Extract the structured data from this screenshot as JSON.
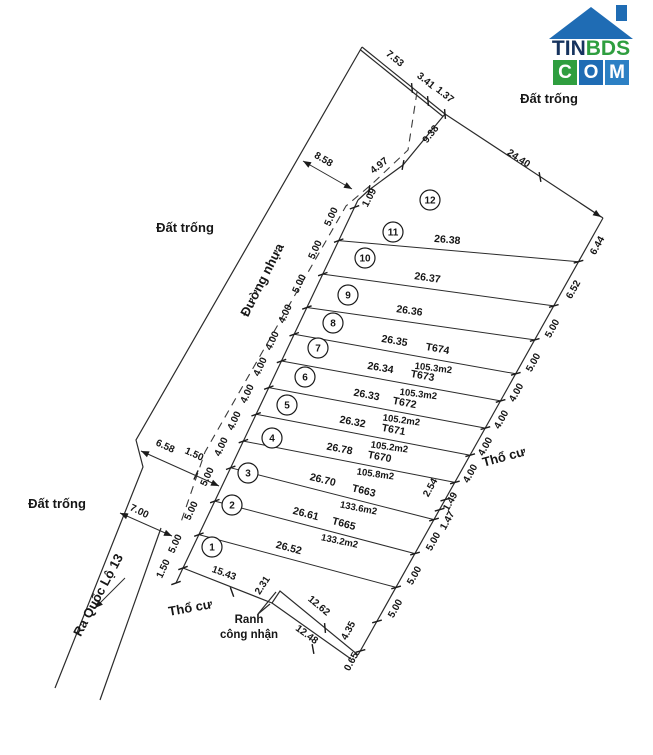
{
  "logo": {
    "word_part1": "TIN",
    "word_part2": "BDS",
    "tiles": [
      "C",
      "O",
      "M"
    ],
    "colors": {
      "roof": "#1f6cb4",
      "dark_text": "#16335e",
      "green": "#2f9e3f",
      "blue": "#1f6cb4",
      "blue2": "#2c80c4"
    }
  },
  "diagram": {
    "ink": "#2b2b2b",
    "solid": [
      {
        "name": "north-boundary-double-line",
        "pts": [
          [
            362,
            47
          ],
          [
            445,
            114
          ]
        ],
        "double": 1
      },
      {
        "name": "plot12-road-corner-edge",
        "pts": [
          [
            445,
            114
          ],
          [
            403,
            165
          ],
          [
            369,
            190
          ],
          [
            358,
            200
          ]
        ]
      },
      {
        "name": "northeast-boundary",
        "pts": [
          [
            445,
            114
          ],
          [
            603,
            218
          ]
        ]
      },
      {
        "name": "road-frontage-line",
        "pts": [
          [
            358,
            200
          ],
          [
            183,
            568
          ],
          [
            176,
            583
          ]
        ]
      },
      {
        "name": "rear-boundary-line",
        "pts": [
          [
            603,
            218
          ],
          [
            358,
            655
          ]
        ]
      },
      {
        "name": "south-boundary-upper",
        "pts": [
          [
            358,
            655
          ],
          [
            280,
            591
          ],
          [
            272,
            603
          ],
          [
            183,
            568
          ]
        ]
      },
      {
        "name": "recognized-boundary-line",
        "pts": [
          [
            351,
            659
          ],
          [
            272,
            603
          ]
        ]
      },
      {
        "name": "road-west-boundary",
        "pts": [
          [
            362,
            47
          ],
          [
            136,
            440
          ],
          [
            143,
            467
          ],
          [
            55,
            688
          ]
        ]
      },
      {
        "name": "road-east-lower-boundary",
        "pts": [
          [
            161,
            528
          ],
          [
            100,
            700
          ]
        ]
      },
      {
        "name": "ranh-leader-1",
        "pts": [
          [
            258,
            614
          ],
          [
            276,
            592
          ]
        ]
      },
      {
        "name": "ranh-leader-2",
        "pts": [
          [
            258,
            614
          ],
          [
            270,
            604
          ]
        ]
      }
    ],
    "dash": [
      {
        "name": "road-edge-dashed",
        "pts": [
          [
            417,
            92
          ],
          [
            408,
            150
          ],
          [
            372,
            184
          ],
          [
            346,
            206
          ],
          [
            205,
            452
          ],
          [
            180,
            525
          ]
        ]
      }
    ],
    "divisions": [
      {
        "p": [
          338.7,
          240.6,
          578.5,
          261.7
        ],
        "len": "26.38",
        "lx": 447,
        "ly": 243,
        "lr": 5
      },
      {
        "p": [
          322.8,
          274.1,
          553.8,
          305.9
        ],
        "len": "26.37",
        "lx": 427,
        "ly": 281,
        "lr": 8
      },
      {
        "p": [
          306.9,
          307.5,
          534.7,
          339.9
        ],
        "len": "26.36",
        "lx": 409,
        "ly": 314,
        "lr": 8
      },
      {
        "p": [
          294.2,
          334.2,
          515.8,
          373.8
        ],
        "len": "26.35",
        "lx": 394,
        "ly": 344,
        "lr": 10,
        "code": "T674",
        "cx": 437,
        "cy": 352,
        "area": "105.3m2",
        "ax": 433,
        "ay": 371
      },
      {
        "p": [
          281.5,
          361.0,
          500.6,
          400.9
        ],
        "len": "26.34",
        "lx": 380,
        "ly": 371,
        "lr": 10,
        "code": "T673",
        "cx": 422,
        "cy": 379,
        "area": "105.3m2",
        "ax": 418,
        "ay": 397
      },
      {
        "p": [
          268.8,
          387.6,
          485.4,
          428.1
        ],
        "len": "26.33",
        "lx": 366,
        "ly": 398,
        "lr": 11,
        "code": "T672",
        "cx": 404,
        "cy": 406,
        "area": "105.2m2",
        "ax": 401,
        "ay": 423
      },
      {
        "p": [
          256.1,
          414.3,
          470.2,
          455.2
        ],
        "len": "26.32",
        "lx": 352,
        "ly": 425,
        "lr": 11,
        "code": "T671",
        "cx": 393,
        "cy": 433,
        "area": "105.2m2",
        "ax": 389,
        "ay": 450
      },
      {
        "p": [
          243.4,
          441.1,
          454.9,
          482.4
        ],
        "len": "26.78",
        "lx": 339,
        "ly": 452,
        "lr": 11,
        "code": "T670",
        "cx": 379,
        "cy": 460,
        "area": "105.8m2",
        "ax": 375,
        "ay": 477
      },
      {
        "p": [
          230.7,
          467.8,
          434.0,
          519.6
        ],
        "len": "26.70",
        "lx": 322,
        "ly": 483,
        "lr": 14,
        "code": "T663",
        "cx": 363,
        "cy": 494,
        "area": "133.6m2",
        "ax": 358,
        "ay": 511
      },
      {
        "p": [
          214.8,
          501.1,
          415.0,
          553.6
        ],
        "len": "26.61",
        "lx": 305,
        "ly": 517,
        "lr": 15,
        "code": "T665",
        "cx": 343,
        "cy": 527,
        "area": "133.2m2",
        "ax": 339,
        "ay": 544
      },
      {
        "p": [
          198.9,
          534.6,
          396.1,
          587.4
        ],
        "len": "26.52",
        "lx": 288,
        "ly": 551,
        "lr": 15
      }
    ],
    "plots": [
      {
        "n": "12",
        "x": 430,
        "y": 200
      },
      {
        "n": "11",
        "x": 393,
        "y": 232
      },
      {
        "n": "10",
        "x": 365,
        "y": 258
      },
      {
        "n": "9",
        "x": 348,
        "y": 295
      },
      {
        "n": "8",
        "x": 333,
        "y": 323
      },
      {
        "n": "7",
        "x": 318,
        "y": 348
      },
      {
        "n": "6",
        "x": 305,
        "y": 377
      },
      {
        "n": "5",
        "x": 287,
        "y": 405
      },
      {
        "n": "4",
        "x": 272,
        "y": 438
      },
      {
        "n": "3",
        "x": 248,
        "y": 473
      },
      {
        "n": "2",
        "x": 232,
        "y": 505
      },
      {
        "n": "1",
        "x": 212,
        "y": 547
      }
    ],
    "dims": [
      {
        "t": "7.53",
        "x": 393,
        "y": 61,
        "r": 39
      },
      {
        "t": "3.41",
        "x": 424,
        "y": 83,
        "r": 39
      },
      {
        "t": "1.37",
        "x": 443,
        "y": 97,
        "r": 39
      },
      {
        "t": "24.40",
        "x": 517,
        "y": 161,
        "r": 33
      },
      {
        "t": "9.38",
        "x": 433,
        "y": 136,
        "r": -52
      },
      {
        "t": "4.97",
        "x": 381,
        "y": 168,
        "r": -38
      },
      {
        "t": "1.09",
        "x": 372,
        "y": 199,
        "r": -62
      },
      {
        "t": "8.58",
        "x": 322,
        "y": 162,
        "r": 30
      },
      {
        "t": "6.58",
        "x": 164,
        "y": 449,
        "r": 24
      },
      {
        "t": "1.50",
        "x": 193,
        "y": 457,
        "r": 24
      },
      {
        "t": "7.00",
        "x": 138,
        "y": 514,
        "r": 26
      },
      {
        "t": "1.50",
        "x": 166,
        "y": 570,
        "r": -65
      },
      {
        "t": "15.43",
        "x": 223,
        "y": 576,
        "r": 20
      },
      {
        "t": "2.31",
        "x": 265,
        "y": 587,
        "r": -57
      },
      {
        "t": "12.62",
        "x": 317,
        "y": 608,
        "r": 40
      },
      {
        "t": "12.48",
        "x": 305,
        "y": 637,
        "r": 36
      },
      {
        "t": "4.35",
        "x": 351,
        "y": 632,
        "r": -62
      },
      {
        "t": "0.65",
        "x": 354,
        "y": 663,
        "r": -62
      },
      {
        "t": "5.00",
        "x": 334,
        "y": 218,
        "r": -65
      },
      {
        "t": "5.00",
        "x": 318,
        "y": 251,
        "r": -65
      },
      {
        "t": "5.00",
        "x": 302,
        "y": 285,
        "r": -65
      },
      {
        "t": "4.00",
        "x": 288,
        "y": 315,
        "r": -65
      },
      {
        "t": "4.00",
        "x": 275,
        "y": 342,
        "r": -65
      },
      {
        "t": "4.00",
        "x": 263,
        "y": 368,
        "r": -65
      },
      {
        "t": "4.00",
        "x": 250,
        "y": 395,
        "r": -65
      },
      {
        "t": "4.00",
        "x": 237,
        "y": 422,
        "r": -65
      },
      {
        "t": "4.00",
        "x": 224,
        "y": 448,
        "r": -65
      },
      {
        "t": "5.00",
        "x": 210,
        "y": 478,
        "r": -65
      },
      {
        "t": "5.00",
        "x": 194,
        "y": 512,
        "r": -65
      },
      {
        "t": "5.00",
        "x": 178,
        "y": 545,
        "r": -65
      },
      {
        "t": "6.44",
        "x": 600,
        "y": 247,
        "r": -61
      },
      {
        "t": "6.52",
        "x": 576,
        "y": 291,
        "r": -61
      },
      {
        "t": "5.00",
        "x": 555,
        "y": 330,
        "r": -61
      },
      {
        "t": "5.00",
        "x": 536,
        "y": 364,
        "r": -61
      },
      {
        "t": "4.00",
        "x": 519,
        "y": 394,
        "r": -61
      },
      {
        "t": "4.00",
        "x": 504,
        "y": 421,
        "r": -61
      },
      {
        "t": "4.00",
        "x": 488,
        "y": 448,
        "r": -61
      },
      {
        "t": "4.00",
        "x": 473,
        "y": 475,
        "r": -61
      },
      {
        "t": "2.54",
        "x": 433,
        "y": 489,
        "r": -61
      },
      {
        "t": "1.49",
        "x": 453,
        "y": 503,
        "r": -61
      },
      {
        "t": "1.47",
        "x": 450,
        "y": 522,
        "r": -61
      },
      {
        "t": "5.00",
        "x": 436,
        "y": 543,
        "r": -61
      },
      {
        "t": "5.00",
        "x": 417,
        "y": 577,
        "r": -61
      },
      {
        "t": "5.00",
        "x": 398,
        "y": 610,
        "r": -61
      }
    ],
    "labels": [
      {
        "t": "Đất trống",
        "x": 185,
        "y": 232,
        "r": 0,
        "cls": "vn",
        "name": "label-dat-trong-west"
      },
      {
        "t": "Đất trống",
        "x": 549,
        "y": 103,
        "r": 0,
        "cls": "vn",
        "name": "label-dat-trong-northeast"
      },
      {
        "t": "Đất trống",
        "x": 57,
        "y": 508,
        "r": 0,
        "cls": "vn",
        "name": "label-dat-trong-southwest"
      },
      {
        "t": "Đường nhựa",
        "x": 266,
        "y": 282,
        "r": -63,
        "cls": "vn",
        "name": "label-duong-nhua"
      },
      {
        "t": "Thổ cư",
        "x": 505,
        "y": 461,
        "r": -15,
        "cls": "vn",
        "name": "label-tho-cu-east"
      },
      {
        "t": "Thổ cư",
        "x": 191,
        "y": 612,
        "r": -10,
        "cls": "vn",
        "name": "label-tho-cu-south"
      },
      {
        "t": "Ra Quốc Lộ 13",
        "x": 102,
        "y": 597,
        "r": -62,
        "cls": "vn",
        "name": "label-ra-quoc-lo-13"
      },
      {
        "t": "Ranh",
        "x": 249,
        "y": 623,
        "r": 0,
        "cls": "vnsm",
        "name": "label-ranh-cong-nhan-line1"
      },
      {
        "t": "công nhận",
        "x": 249,
        "y": 638,
        "r": 0,
        "cls": "vnsm",
        "name": "label-ranh-cong-nhan-line2"
      }
    ],
    "arrows": [
      {
        "p": [
          303,
          161,
          352,
          189
        ],
        "heads": 2,
        "name": "dim-arrow-8-58"
      },
      {
        "p": [
          141,
          451,
          219,
          486
        ],
        "heads": 2,
        "name": "dim-arrow-6-58-1-50"
      },
      {
        "p": [
          120,
          513,
          172,
          536
        ],
        "heads": 2,
        "name": "dim-arrow-7-00"
      },
      {
        "p": [
          125,
          578,
          95,
          608
        ],
        "heads": 1,
        "name": "direction-arrow-quoc-lo-13"
      },
      {
        "p": [
          580,
          203,
          601,
          217
        ],
        "heads": 1,
        "name": "dim-arrow-24-40-end"
      }
    ],
    "ticks": [
      [
        354.5,
        207.3,
        160
      ],
      [
        338.7,
        240.6,
        160
      ],
      [
        322.8,
        274.1,
        160
      ],
      [
        306.9,
        307.5,
        160
      ],
      [
        294.2,
        334.2,
        160
      ],
      [
        281.5,
        361,
        160
      ],
      [
        268.8,
        387.6,
        160
      ],
      [
        256.1,
        414.3,
        160
      ],
      [
        243.4,
        441.1,
        160
      ],
      [
        230.7,
        467.8,
        160
      ],
      [
        214.8,
        501.1,
        160
      ],
      [
        198.9,
        534.6,
        160
      ],
      [
        183,
        568,
        160
      ],
      [
        176,
        583,
        160
      ],
      [
        578.5,
        261.7,
        164
      ],
      [
        553.8,
        305.9,
        164
      ],
      [
        534.7,
        339.9,
        164
      ],
      [
        515.8,
        373.8,
        164
      ],
      [
        500.6,
        400.9,
        164
      ],
      [
        485.4,
        428.1,
        164
      ],
      [
        470.2,
        455.2,
        164
      ],
      [
        454.9,
        482.4,
        164
      ],
      [
        445.3,
        499.6,
        164
      ],
      [
        439.6,
        509.7,
        164
      ],
      [
        434,
        519.6,
        164
      ],
      [
        415,
        553.6,
        164
      ],
      [
        396.1,
        587.4,
        164
      ],
      [
        377,
        621.4,
        164
      ],
      [
        360.5,
        650.9,
        164
      ],
      [
        412,
        88,
        85
      ],
      [
        428,
        101,
        85
      ],
      [
        445,
        114,
        85
      ],
      [
        403,
        165,
        100
      ],
      [
        369,
        190,
        100
      ],
      [
        196,
        475,
        115
      ],
      [
        232,
        592,
        70
      ],
      [
        325,
        628,
        85
      ],
      [
        313,
        649,
        80
      ],
      [
        540,
        177,
        80
      ]
    ]
  }
}
